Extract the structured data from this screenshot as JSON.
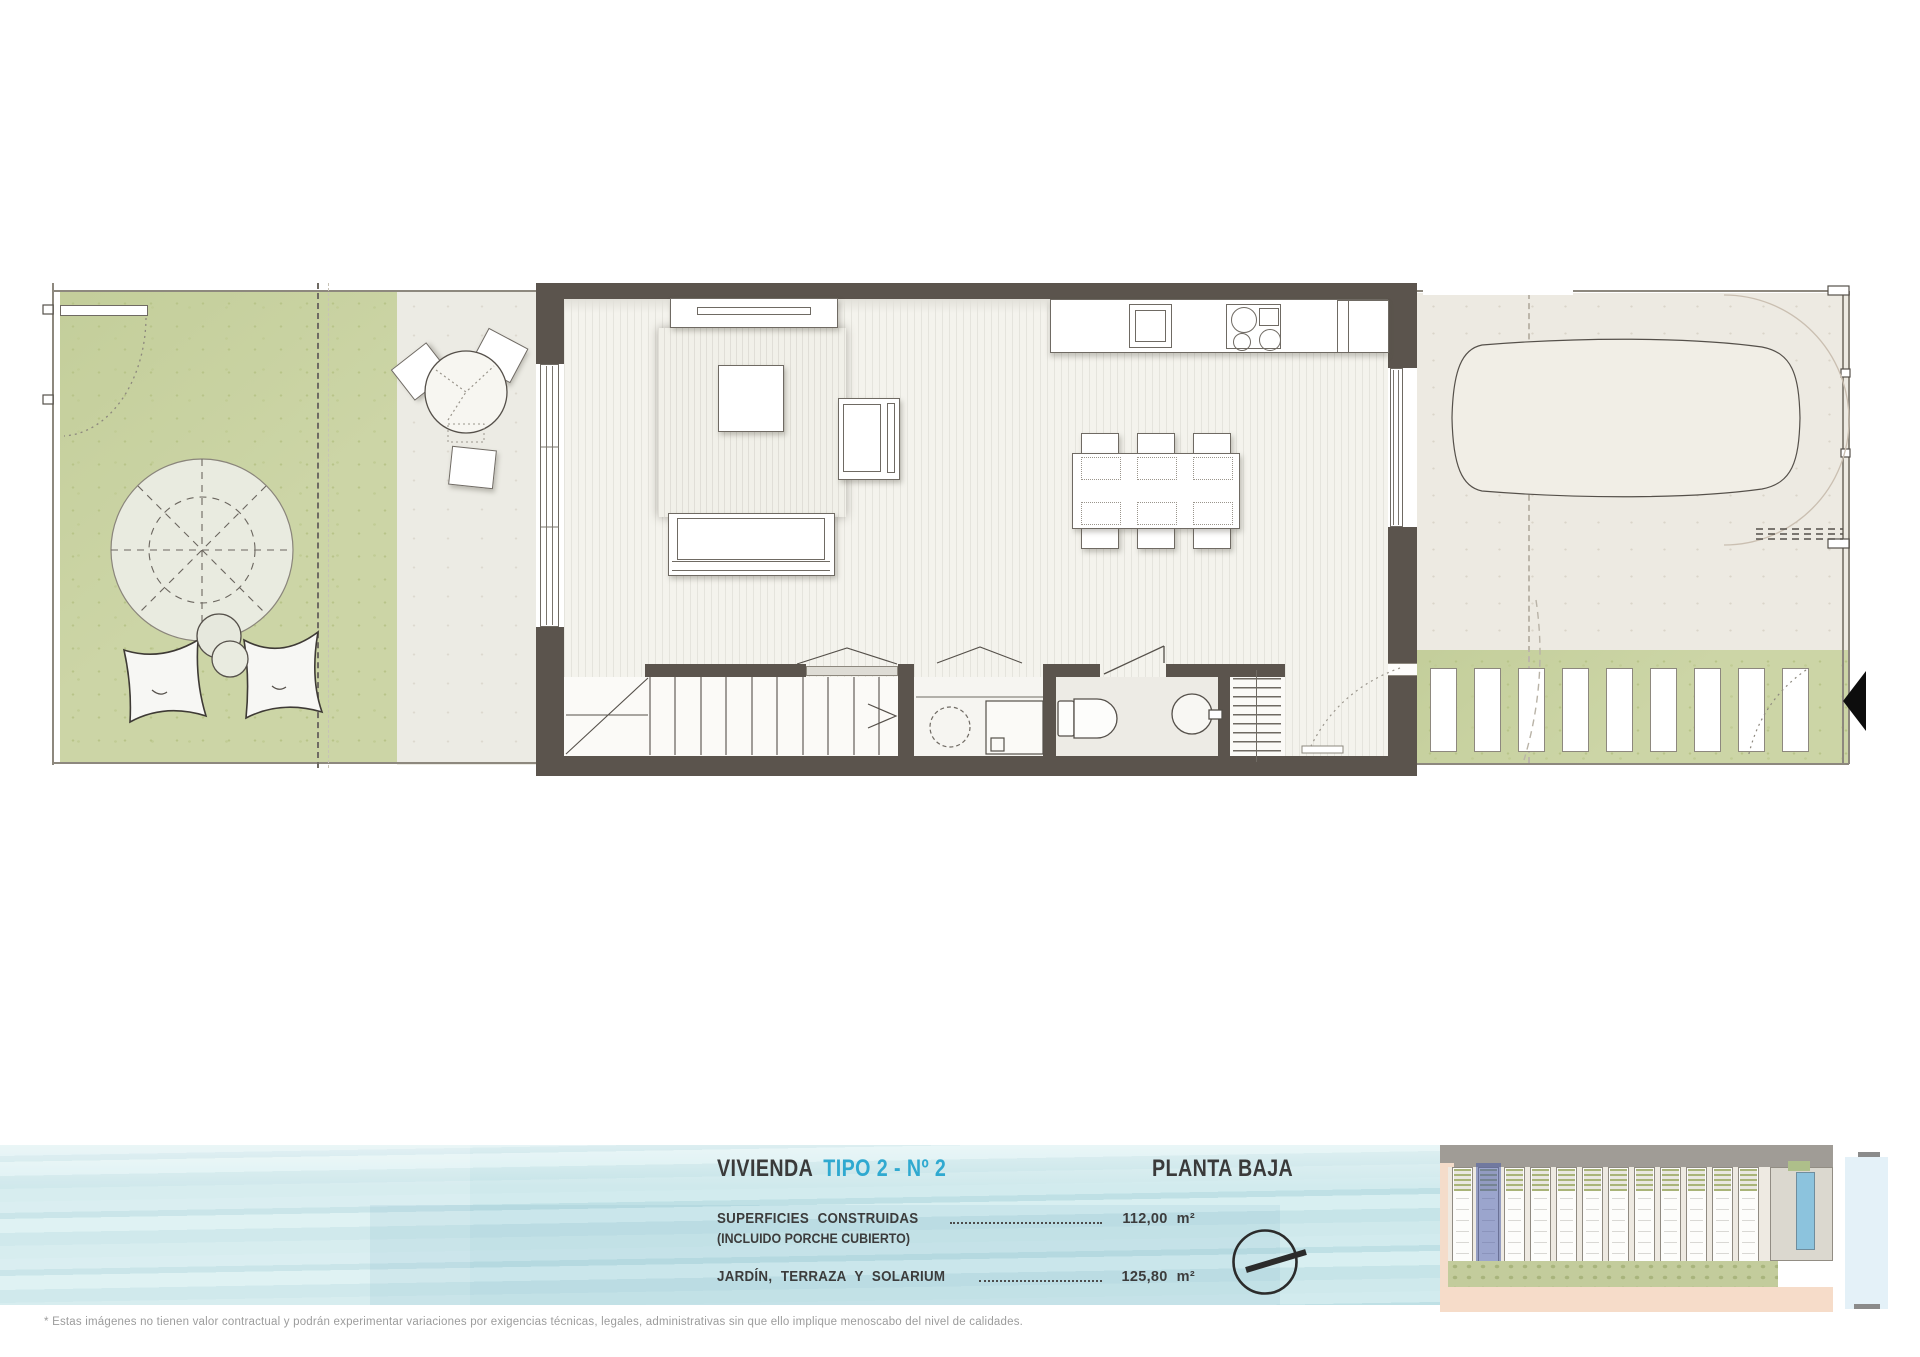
{
  "header": {
    "title_prefix": "VIVIENDA",
    "title_type": "TIPO 2 - Nº 2",
    "floor_label": "PLANTA BAJA"
  },
  "surfaces": {
    "row1_label": "SUPERFICIES  CONSTRUIDAS",
    "row1_sublabel": "(INCLUIDO PORCHE CUBIERTO)",
    "row1_value": "112,00",
    "row1_unit": "m²",
    "row2_label": "JARDÍN,  TERRAZA  Y  SOLARIUM",
    "row2_value": "125,80",
    "row2_unit": "m²"
  },
  "footer": {
    "disclaimer": "* Estas imágenes no tienen valor contractual y podrán experimentar variaciones por exigencias técnicas, legales, administrativas sin que ello implique menoscabo del nivel de calidades."
  },
  "colors": {
    "accent_cyan": "#2fa9d0",
    "wall_dark": "#5b544d",
    "garden_green": "#ccd5a6",
    "water_base": "#cde8ec",
    "site_highlight": "#4a5ca8",
    "text_dark": "#3c3c3c"
  },
  "site_plan": {
    "units": 12,
    "highlighted_unit_index": 1
  }
}
